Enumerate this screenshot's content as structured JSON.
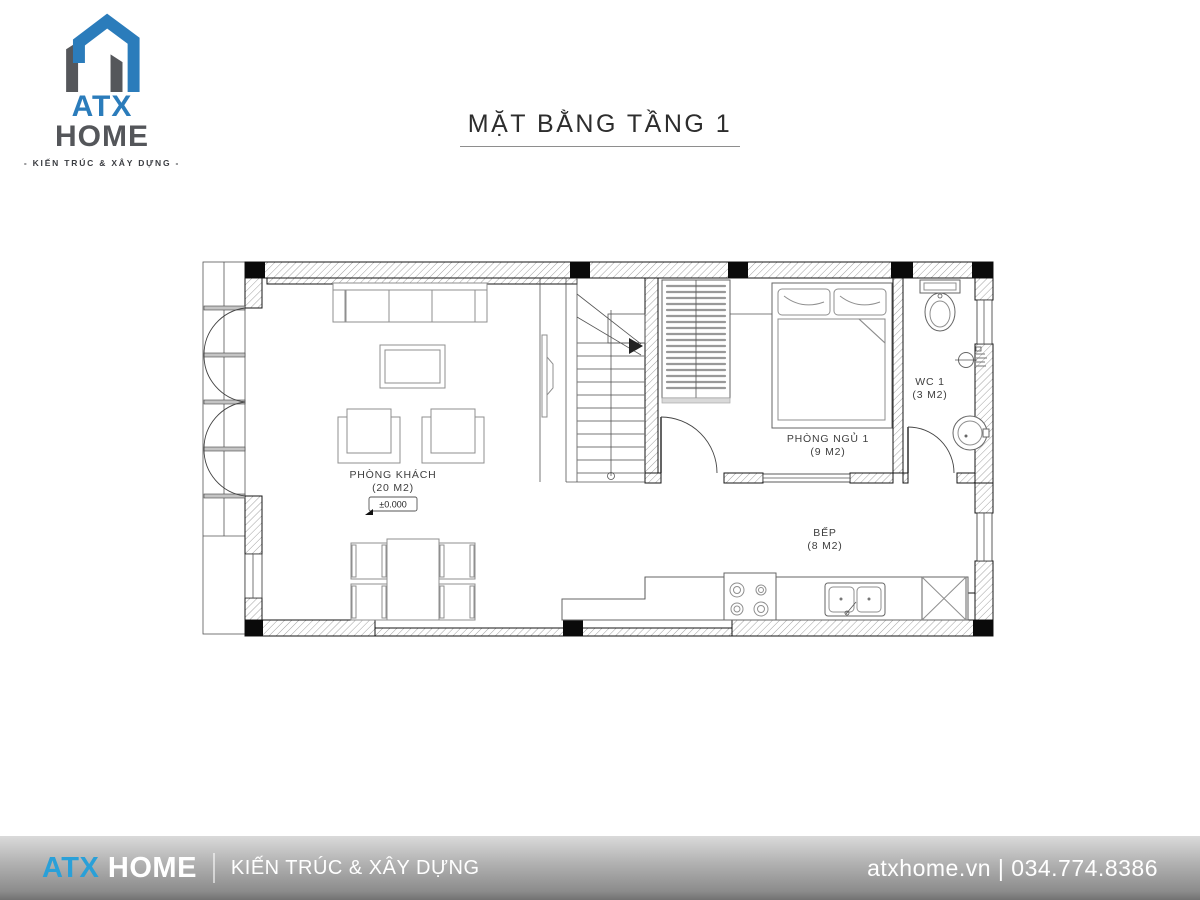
{
  "header": {
    "title": "MẶT BẰNG TẦNG 1",
    "logo": {
      "name_primary": "ATX",
      "name_secondary": "HOME",
      "tagline": "- KIẾN TRÚC & XÂY DỰNG -"
    }
  },
  "plan": {
    "rooms": {
      "living": {
        "name": "PHÒNG KHÁCH",
        "area": "(20 M2)"
      },
      "bedroom": {
        "name": "PHÒNG NGỦ 1",
        "area": "(9 M2)"
      },
      "wc": {
        "name": "WC 1",
        "area": "(3 M2)"
      },
      "kitchen": {
        "name": "BẾP",
        "area": "(8 M2)"
      }
    },
    "level_marker": "±0.000"
  },
  "footer": {
    "brand_primary": "ATX",
    "brand_secondary": "HOME",
    "tagline": "KIẾN TRÚC & XÂY DỰNG",
    "website": "atxhome.vn",
    "separator": "|",
    "phone": "034.774.8386"
  },
  "colors": {
    "logo_blue": "#2b7cbb",
    "logo_gray": "#54565a",
    "footer_blue": "#2aa0d8",
    "plan_line": "#141414"
  }
}
